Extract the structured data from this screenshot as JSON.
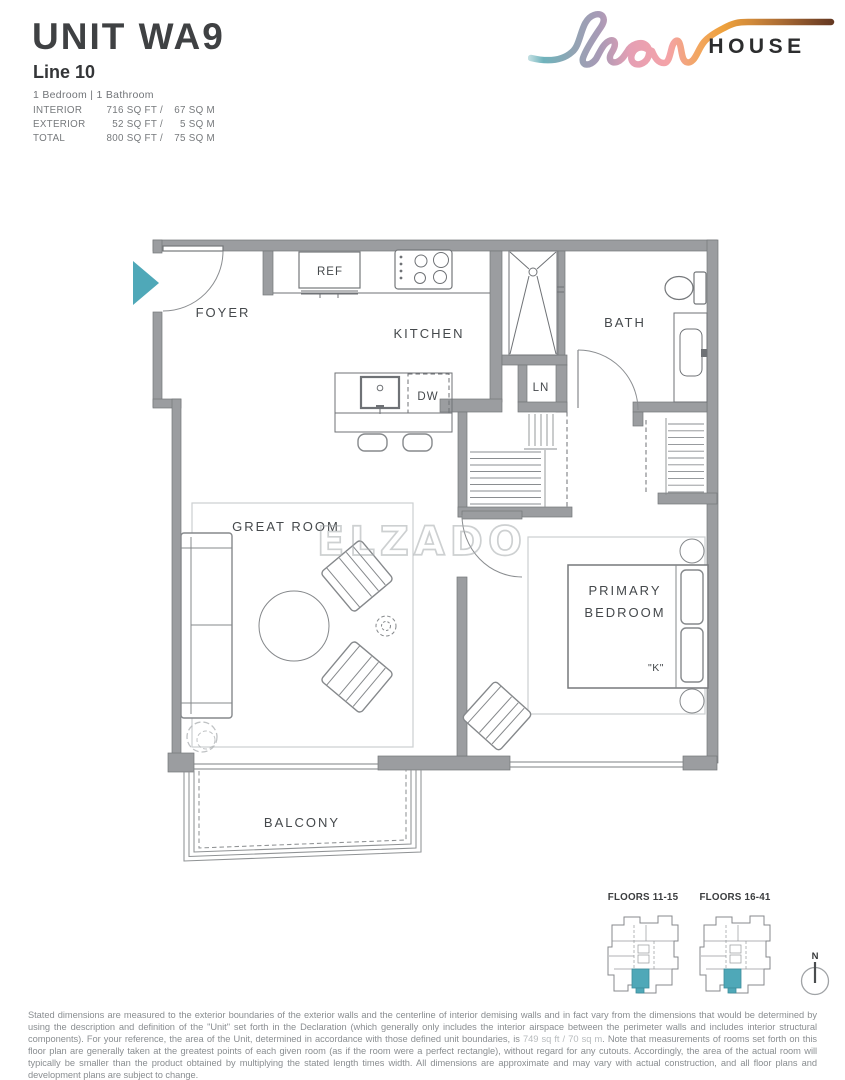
{
  "header": {
    "unit_title": "UNIT WA9",
    "line_label": "Line 10",
    "bed_bath": "1 Bedroom | 1 Bathroom",
    "stats": {
      "rows": [
        {
          "label": "INTERIOR",
          "sqft": "716 SQ FT /",
          "sqm": "67 SQ M"
        },
        {
          "label": "EXTERIOR",
          "sqft": "52 SQ FT /",
          "sqm": "5 SQ M"
        },
        {
          "label": "TOTAL",
          "sqft": "800 SQ FT /",
          "sqm": "75 SQ M"
        }
      ]
    }
  },
  "logo": {
    "script_word": "flow",
    "wordmark": "HOUSE"
  },
  "floor_plan": {
    "watermark": "ELZADO",
    "labels": {
      "foyer": "FOYER",
      "kitchen": "KITCHEN",
      "bath": "BATH",
      "linen": "LN",
      "ref": "REF",
      "dishwasher": "DW",
      "great_room": "GREAT ROOM",
      "primary_bedroom_line1": "PRIMARY",
      "primary_bedroom_line2": "BEDROOM",
      "bed_size": "\"K\"",
      "balcony": "BALCONY"
    }
  },
  "key_plans": {
    "plan1_label": "FLOORS 11-15",
    "plan2_label": "FLOORS 16-41",
    "compass_north": "N",
    "highlight_color": "#4FA8B8"
  },
  "disclaimer": {
    "part1": "Stated dimensions are measured to the exterior boundaries of the exterior walls and the centerline of interior demising walls and in fact vary from the dimensions that would be determined by using the description and definition of the \"Unit\" set forth in the Declaration (which generally only includes the interior airspace between the perimeter walls  and includes interior structural components).  For your reference, the area of the Unit, determined in accordance with those defined unit boundaries, is ",
    "area_value": "749 sq ft / 70 sq m",
    "part2": ".  Note that measurements of rooms set forth on this floor plan are generally taken at the greatest points of each given room (as if the room were a perfect rectangle), without regard for any cutouts.  Accordingly, the area of the actual room will typically be smaller than the product obtained by multiplying the stated length times width.  All dimensions are approximate and may vary with actual construction, and all floor plans and development plans are subject to change."
  },
  "colors": {
    "accent_teal": "#4FA8B8",
    "wall_gray": "#9b9da0"
  }
}
